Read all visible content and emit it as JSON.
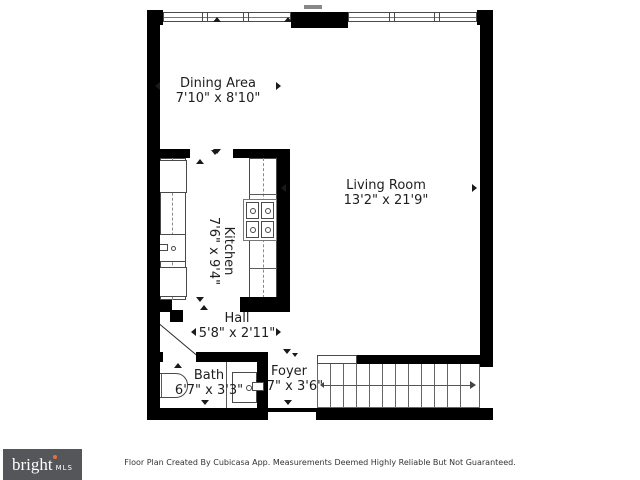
{
  "page": {
    "background": "#ffffff"
  },
  "branding": {
    "logo_text": "bright",
    "logo_suffix": "MLS",
    "logo_bg": "#54565a",
    "logo_accent": "#e8703a"
  },
  "footer": {
    "disclaimer": "Floor Plan Created By Cubicasa App. Measurements Deemed Highly Reliable But Not Guaranteed."
  },
  "floor_plan": {
    "wall_color": "#000000",
    "rooms": [
      {
        "name": "Dining Area",
        "dimensions": "7'10\" x 8'10\""
      },
      {
        "name": "Living Room",
        "dimensions": "13'2\" x 21'9\""
      },
      {
        "name": "Kitchen",
        "dimensions": "7'6\" x 9'4\""
      },
      {
        "name": "Hall",
        "dimensions": "5'8\" x 2'11\""
      },
      {
        "name": "Bath",
        "dimensions": "6'7\" x 3'3\""
      },
      {
        "name": "Foyer",
        "dimensions": "3'7\" x 3'6\""
      }
    ],
    "fixtures": [
      "windows",
      "refrigerator",
      "kitchen-sink",
      "stove",
      "kitchen-counters",
      "bathtub",
      "vanity-sink",
      "staircase",
      "door-swing",
      "entry-door"
    ]
  }
}
